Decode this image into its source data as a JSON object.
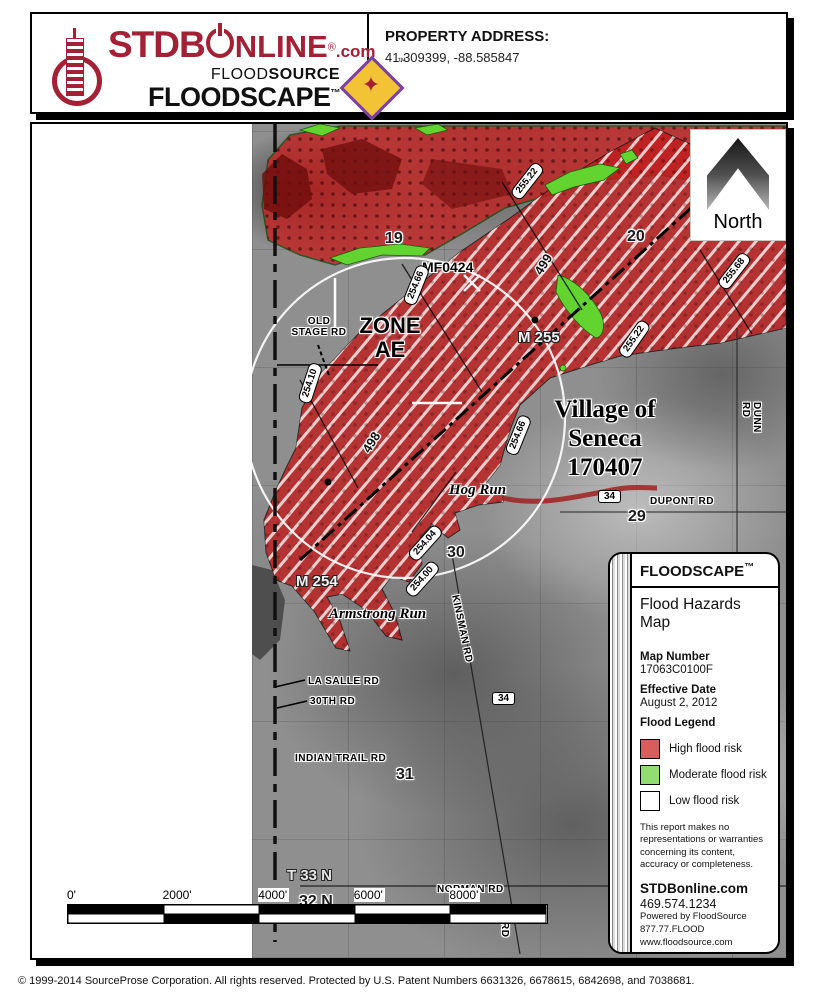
{
  "header": {
    "logo": {
      "stdb": "STDB",
      "online": "NLINE",
      "reg": "®",
      "dotcom": ".com",
      "floodsource_light": "FLOOD",
      "floodsource_bold": "SOURCE",
      "floodscape": "FLOODSCAPE",
      "tm": "™",
      "brand_color": "#a32035"
    },
    "property_address_label": "PROPERTY ADDRESS:",
    "property_address_value": "41.309399, -88.585847"
  },
  "map": {
    "north_label": "North",
    "scale_bar": {
      "ticks": [
        "0'",
        "2000'",
        "4000'",
        "6000'",
        "8000'"
      ]
    },
    "labels": [
      {
        "text": "19",
        "x": 353,
        "y": 106,
        "cls": "section halo"
      },
      {
        "text": "20",
        "x": 595,
        "y": 104,
        "cls": "section halo"
      },
      {
        "text": "29",
        "x": 596,
        "y": 384,
        "cls": "section halo"
      },
      {
        "text": "30",
        "x": 415,
        "y": 420,
        "cls": "section halo"
      },
      {
        "text": "31",
        "x": 364,
        "y": 642,
        "cls": "section halo"
      },
      {
        "text": "MF0424",
        "x": 390,
        "y": 136,
        "cls": "road halo"
      },
      {
        "text": "255.22",
        "x": 475,
        "y": 50,
        "cls": "elev",
        "rot": -52
      },
      {
        "text": "255.68",
        "x": 682,
        "y": 140,
        "cls": "elev",
        "rot": -52
      },
      {
        "text": "255.22",
        "x": 582,
        "y": 208,
        "cls": "elev",
        "rot": -55
      },
      {
        "text": "254.66",
        "x": 364,
        "y": 154,
        "cls": "elev",
        "rot": -68
      },
      {
        "text": "254.66",
        "x": 466,
        "y": 304,
        "cls": "elev",
        "rot": -68
      },
      {
        "text": "254.10",
        "x": 258,
        "y": 252,
        "cls": "elev",
        "rot": -72
      },
      {
        "text": "254.04",
        "x": 373,
        "y": 412,
        "cls": "elev",
        "rot": -48
      },
      {
        "text": "254.00",
        "x": 370,
        "y": 448,
        "cls": "elev",
        "rot": -48
      },
      {
        "text": "499",
        "x": 500,
        "y": 146,
        "cls": "mile halo",
        "rot": -58
      },
      {
        "text": "498",
        "x": 328,
        "y": 324,
        "cls": "mile halo",
        "rot": -58
      },
      {
        "text": "ZONE\nAE",
        "x": 322,
        "y": 190,
        "cls": "zone halo"
      },
      {
        "text": "OLD\nSTAGE RD",
        "x": 252,
        "y": 192,
        "cls": "road-sm halo",
        "center": 70
      },
      {
        "text": "M 255",
        "x": 486,
        "y": 206,
        "cls": "bench-light dhalo"
      },
      {
        "text": "M 254",
        "x": 264,
        "y": 450,
        "cls": "bench-light dhalo"
      },
      {
        "text": "Village of\nSeneca\n170407",
        "x": 518,
        "y": 272,
        "cls": "city halo"
      },
      {
        "text": "DUNN RD",
        "x": 730,
        "y": 278,
        "cls": "road-sm halo",
        "rot": 90
      },
      {
        "text": "DUPONT RD",
        "x": 618,
        "y": 372,
        "cls": "road-sm halo"
      },
      {
        "text": "34",
        "x": 566,
        "y": 366,
        "cls": "shield"
      },
      {
        "text": "34",
        "x": 460,
        "y": 568,
        "cls": "shield"
      },
      {
        "text": "Hog Run",
        "x": 417,
        "y": 358,
        "cls": "stream halo"
      },
      {
        "text": "Armstrong Run",
        "x": 297,
        "y": 482,
        "cls": "stream halo"
      },
      {
        "text": "KINSMAN RD",
        "x": 428,
        "y": 470,
        "cls": "road-sm halo",
        "rot": 78
      },
      {
        "text": "LA SALLE RD",
        "x": 276,
        "y": 552,
        "cls": "road-sm halo"
      },
      {
        "text": "30TH RD",
        "x": 278,
        "y": 572,
        "cls": "road-sm halo"
      },
      {
        "text": "INDIAN TRAIL RD",
        "x": 263,
        "y": 629,
        "cls": "road-sm halo"
      },
      {
        "text": "T 33 N",
        "x": 255,
        "y": 744,
        "cls": "township dhalo"
      },
      {
        "text": "32 N",
        "x": 267,
        "y": 769,
        "cls": "section halo"
      },
      {
        "text": "NORMAN RD",
        "x": 405,
        "y": 760,
        "cls": "road-sm halo"
      },
      {
        "text": "RD",
        "x": 478,
        "y": 798,
        "cls": "road-sm halo",
        "rot": 90
      }
    ]
  },
  "legend": {
    "title": "FLOODSCAPE",
    "tm": "™",
    "subtitle": "Flood Hazards Map",
    "map_number_label": "Map Number",
    "map_number": "17063C0100F",
    "effective_date_label": "Effective Date",
    "effective_date": "August 2, 2012",
    "flood_legend_label": "Flood Legend",
    "items": [
      {
        "label": "High flood risk",
        "color": "#d95d5d"
      },
      {
        "label": "Moderate flood risk",
        "color": "#92dd73"
      },
      {
        "label": "Low flood risk",
        "color": "#ffffff"
      }
    ],
    "disclaimer": "This report makes no representations or warranties concerning its content, accuracy or completeness.",
    "site": "STDBonline.com",
    "phone": "469.574.1234",
    "powered_by": "Powered by FloodSource",
    "powered_phone": "877.77.FLOOD",
    "powered_site": "www.floodsource.com"
  },
  "footer": {
    "copyright": "© 1999-2014 SourceProse Corporation. All rights reserved. Protected by U.S. Patent Numbers 6631326, 6678615, 6842698, and 7038681."
  }
}
